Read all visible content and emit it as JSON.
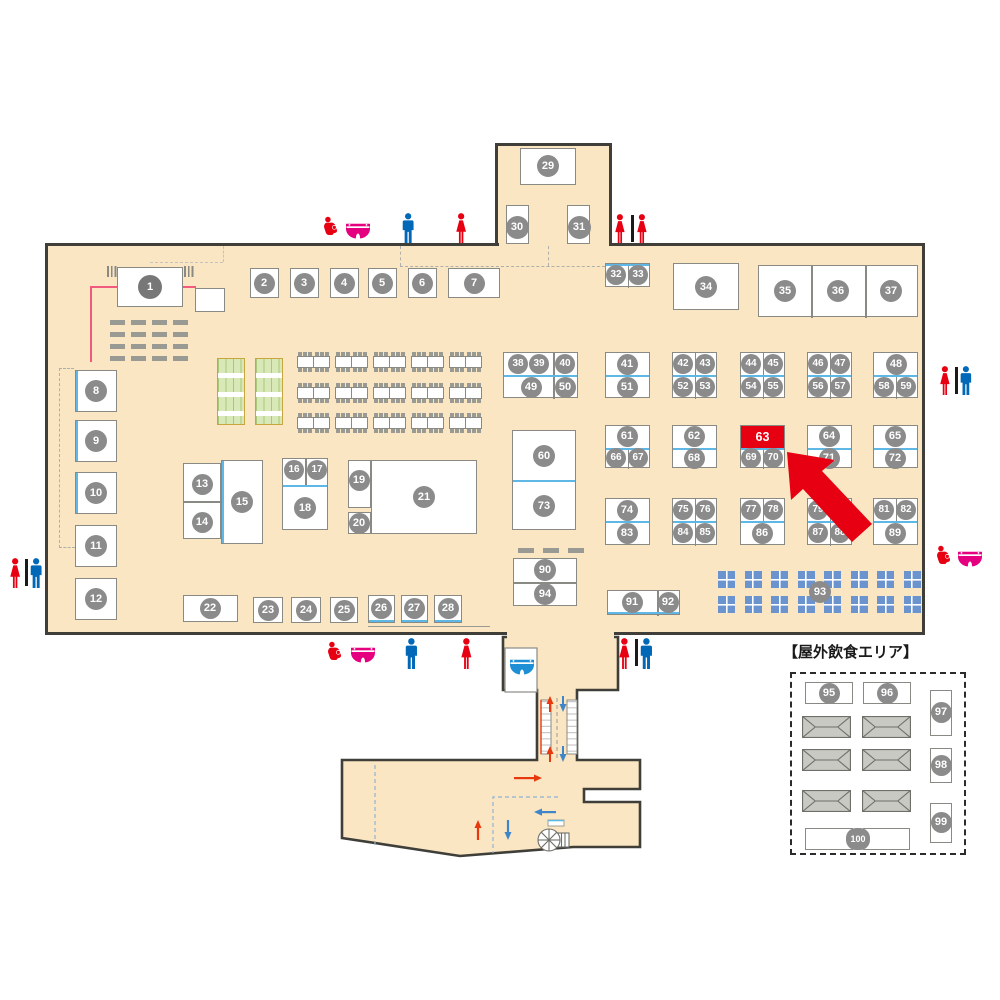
{
  "outdoor_area": {
    "title": "【屋外飲食エリア】"
  },
  "highlighted_booth": "63",
  "booths": [
    "1",
    "2",
    "3",
    "4",
    "5",
    "6",
    "7",
    "8",
    "9",
    "10",
    "11",
    "12",
    "13",
    "14",
    "15",
    "16",
    "17",
    "18",
    "19",
    "20",
    "21",
    "22",
    "23",
    "24",
    "25",
    "26",
    "27",
    "28",
    "29",
    "30",
    "31",
    "32",
    "33",
    "34",
    "35",
    "36",
    "37",
    "38",
    "39",
    "40",
    "41",
    "42",
    "43",
    "44",
    "45",
    "46",
    "47",
    "48",
    "49",
    "50",
    "51",
    "52",
    "53",
    "54",
    "55",
    "56",
    "57",
    "58",
    "59",
    "60",
    "61",
    "62",
    "63",
    "64",
    "65",
    "66",
    "67",
    "68",
    "69",
    "70",
    "71",
    "72",
    "73",
    "74",
    "75",
    "76",
    "77",
    "78",
    "79",
    "80",
    "81",
    "82",
    "83",
    "84",
    "85",
    "86",
    "87",
    "88",
    "89",
    "90",
    "91",
    "92",
    "93",
    "94",
    "95",
    "96",
    "97",
    "98",
    "99",
    "100"
  ],
  "icons": {
    "womens_toilet": "woman-icon",
    "mens_toilet": "man-icon",
    "nursing_room": "nursing-mother-icon",
    "diaper_changing": "diaper-icon",
    "baby_room": "blue-diaper-icon",
    "spiral_stair": "spiral-stair-icon"
  },
  "colors": {
    "floor": "#fae6c3",
    "wall": "#3f3e38",
    "booth_border": "#8a8a85",
    "number_circle": "#8b8b8b",
    "highlight_red": "#e60012",
    "divider_blue": "#5fb7e6",
    "woman_red": "#e60012",
    "man_blue": "#0068b7",
    "diaper_pink": "#e4007f",
    "diaper_blue": "#1e8fd5",
    "window_blue": "#6b93ce",
    "green_table": "#d8e8b6"
  }
}
